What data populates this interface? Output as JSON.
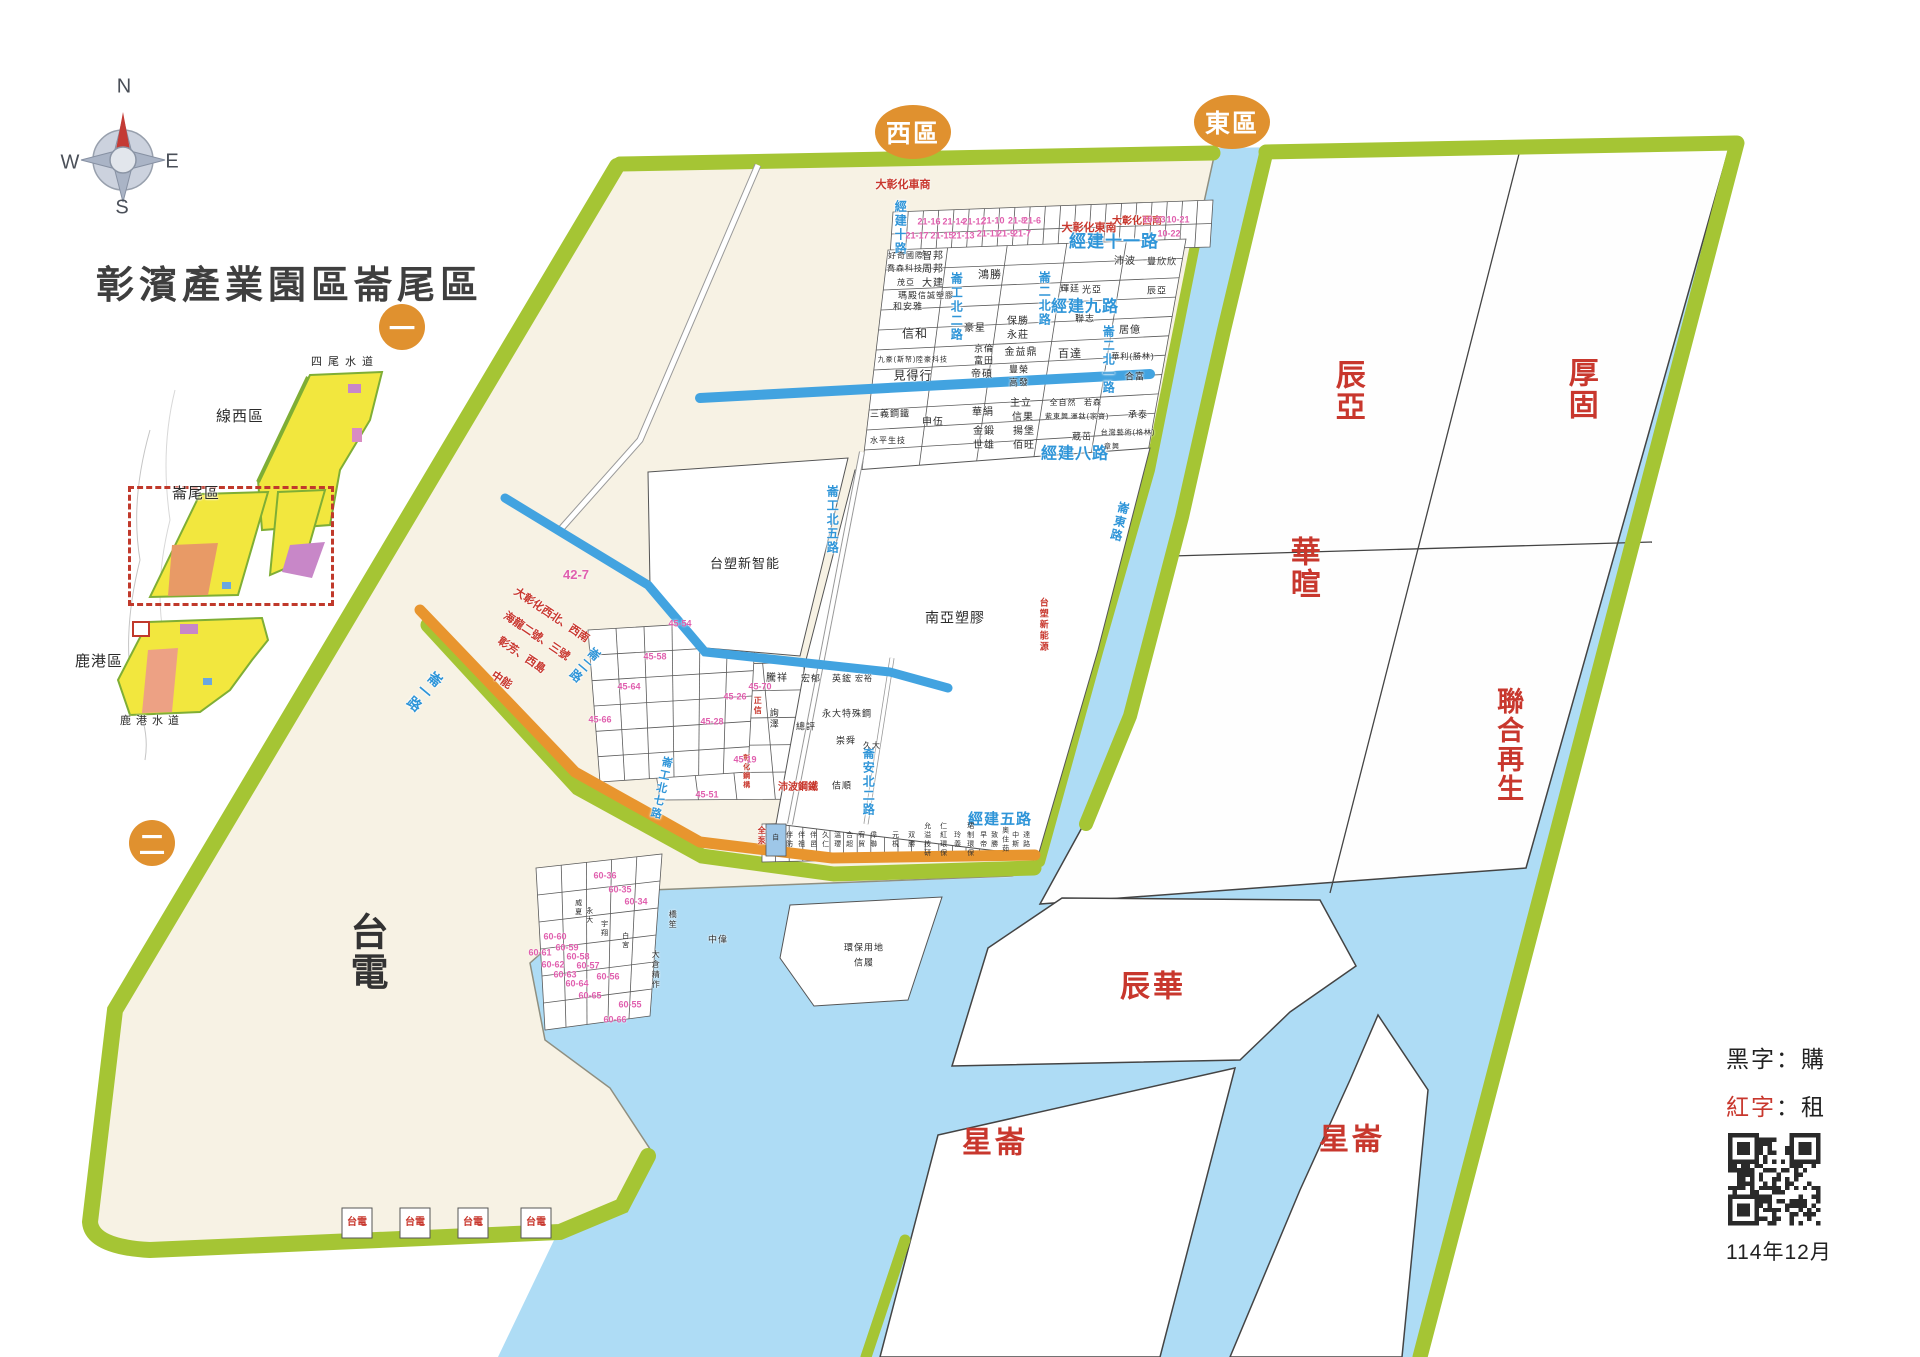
{
  "title": "彰濱產業園區崙尾區",
  "compass": {
    "north": "N",
    "east": "E",
    "south": "S",
    "west": "W"
  },
  "district_badges": {
    "west": "西區",
    "east": "東區",
    "marker_one": "一",
    "marker_two": "二"
  },
  "inset_map": {
    "waterway_top": "四尾水道",
    "zone_north": "線西區",
    "zone_focus": "崙尾區",
    "zone_south": "鹿港區",
    "waterway_bottom": "鹿港水道"
  },
  "legend": {
    "black_key": "黑字",
    "colon": "：",
    "black_value": "購",
    "red_key": "紅字",
    "red_value": "租",
    "date": "114年12月"
  },
  "colors": {
    "belt_green": "#a5c534",
    "water_blue": "#aedcf5",
    "land_cream": "#f7f2e4",
    "road_orange": "#e8952e",
    "channel_blue": "#42a3e0",
    "label_red": "#c8372d",
    "road_label_blue": "#2f95d8",
    "lot_pink": "#e05fae",
    "badge_orange": "#e0912f"
  },
  "map": {
    "zone_labels": [
      {
        "t": "辰亞",
        "x": 1347,
        "y": 391,
        "s": 30,
        "v": 1
      },
      {
        "t": "厚固",
        "x": 1580,
        "y": 389,
        "s": 30,
        "v": 1
      },
      {
        "t": "華暄",
        "x": 1302,
        "y": 568,
        "s": 30,
        "v": 1
      },
      {
        "t": "聯合再生",
        "x": 1508,
        "y": 745,
        "s": 27,
        "v": 1
      },
      {
        "t": "辰華",
        "x": 1153,
        "y": 987,
        "s": 30
      },
      {
        "t": "星崙",
        "x": 995,
        "y": 1143,
        "s": 30
      },
      {
        "t": "星崙",
        "x": 1352,
        "y": 1140,
        "s": 30
      },
      {
        "t": "台電",
        "x": 364,
        "y": 952,
        "s": 38,
        "v": 1,
        "c": "#333"
      }
    ],
    "road_labels": [
      {
        "t": "經建十一路",
        "x": 1114,
        "y": 242,
        "s": 17
      },
      {
        "t": "經建九路",
        "x": 1085,
        "y": 308,
        "s": 16
      },
      {
        "t": "經建八路",
        "x": 1075,
        "y": 455,
        "s": 16
      },
      {
        "t": "經建五路",
        "x": 1000,
        "y": 820,
        "s": 15
      },
      {
        "t": "經建十路",
        "x": 900,
        "y": 228,
        "s": 12,
        "v": 1
      },
      {
        "t": "崙工北二路",
        "x": 956,
        "y": 307,
        "s": 12,
        "v": 1
      },
      {
        "t": "崙二北路",
        "x": 1044,
        "y": 299,
        "s": 12,
        "v": 1
      },
      {
        "t": "崙二北一路",
        "x": 1108,
        "y": 360,
        "s": 12,
        "v": 1
      },
      {
        "t": "崙工北五路",
        "x": 832,
        "y": 520,
        "s": 12,
        "v": 1
      },
      {
        "t": "崙安北二路",
        "x": 868,
        "y": 782,
        "s": 12,
        "v": 1
      },
      {
        "t": "崙東路",
        "x": 1119,
        "y": 522,
        "s": 12,
        "v": 1,
        "r": 14
      },
      {
        "t": "崙工北七路",
        "x": 660,
        "y": 788,
        "s": 11,
        "v": 1,
        "r": 12
      },
      {
        "t": "崙一路",
        "x": 424,
        "y": 692,
        "s": 14,
        "v": 1,
        "r": 40
      },
      {
        "t": "崙二路",
        "x": 584,
        "y": 665,
        "s": 12,
        "v": 1,
        "r": 40
      }
    ],
    "company_labels": [
      {
        "t": "好奇國際",
        "x": 906,
        "y": 256,
        "s": 8
      },
      {
        "t": "智邦",
        "x": 933,
        "y": 257,
        "s": 10
      },
      {
        "t": "喬森科技",
        "x": 905,
        "y": 269,
        "s": 8
      },
      {
        "t": "周邦",
        "x": 933,
        "y": 270,
        "s": 10
      },
      {
        "t": "茂亞",
        "x": 906,
        "y": 283,
        "s": 8
      },
      {
        "t": "大建",
        "x": 933,
        "y": 284,
        "s": 10
      },
      {
        "t": "瑪殿",
        "x": 908,
        "y": 296,
        "s": 9
      },
      {
        "t": "信誠塑膠",
        "x": 936,
        "y": 296,
        "s": 8
      },
      {
        "t": "和安雅",
        "x": 908,
        "y": 307,
        "s": 9
      },
      {
        "t": "鴻勝",
        "x": 990,
        "y": 276,
        "s": 11
      },
      {
        "t": "沛波",
        "x": 1125,
        "y": 262,
        "s": 10
      },
      {
        "t": "豐欣欣",
        "x": 1162,
        "y": 262,
        "s": 9
      },
      {
        "t": "辰亞",
        "x": 1157,
        "y": 291,
        "s": 9
      },
      {
        "t": "輝廷",
        "x": 1070,
        "y": 289,
        "s": 9
      },
      {
        "t": "光亞",
        "x": 1092,
        "y": 290,
        "s": 9
      },
      {
        "t": "保勝",
        "x": 1018,
        "y": 322,
        "s": 10
      },
      {
        "t": "永莊",
        "x": 1018,
        "y": 336,
        "s": 10
      },
      {
        "t": "豪星",
        "x": 975,
        "y": 329,
        "s": 10
      },
      {
        "t": "信和",
        "x": 915,
        "y": 334,
        "s": 12
      },
      {
        "t": "京倫",
        "x": 984,
        "y": 349,
        "s": 9
      },
      {
        "t": "富田",
        "x": 984,
        "y": 361,
        "s": 9
      },
      {
        "t": "金益鼎",
        "x": 1021,
        "y": 353,
        "s": 10
      },
      {
        "t": "帝碩",
        "x": 982,
        "y": 375,
        "s": 10
      },
      {
        "t": "豐榮",
        "x": 1019,
        "y": 370,
        "s": 9
      },
      {
        "t": "高發",
        "x": 1019,
        "y": 383,
        "s": 9
      },
      {
        "t": "九豪(斯帑)",
        "x": 897,
        "y": 360,
        "s": 7
      },
      {
        "t": "陸豪科技",
        "x": 932,
        "y": 360,
        "s": 7
      },
      {
        "t": "見得行",
        "x": 913,
        "y": 376,
        "s": 12
      },
      {
        "t": "三義鋼鐵",
        "x": 890,
        "y": 414,
        "s": 9
      },
      {
        "t": "申伍",
        "x": 933,
        "y": 423,
        "s": 10
      },
      {
        "t": "水平生技",
        "x": 888,
        "y": 441,
        "s": 8
      },
      {
        "t": "華絹",
        "x": 983,
        "y": 413,
        "s": 10
      },
      {
        "t": "主立",
        "x": 1021,
        "y": 404,
        "s": 10
      },
      {
        "t": "信果",
        "x": 1023,
        "y": 418,
        "s": 10
      },
      {
        "t": "金鍛",
        "x": 984,
        "y": 432,
        "s": 10
      },
      {
        "t": "揚堡",
        "x": 1024,
        "y": 432,
        "s": 10
      },
      {
        "t": "世雄",
        "x": 984,
        "y": 446,
        "s": 10
      },
      {
        "t": "佰旺",
        "x": 1024,
        "y": 446,
        "s": 10
      },
      {
        "t": "全自然",
        "x": 1063,
        "y": 403,
        "s": 8
      },
      {
        "t": "若森",
        "x": 1093,
        "y": 403,
        "s": 8
      },
      {
        "t": "紫東興",
        "x": 1057,
        "y": 417,
        "s": 7
      },
      {
        "t": "運鈦(家寶)",
        "x": 1090,
        "y": 417,
        "s": 7
      },
      {
        "t": "承泰",
        "x": 1138,
        "y": 415,
        "s": 9
      },
      {
        "t": "蔵茁",
        "x": 1082,
        "y": 437,
        "s": 9
      },
      {
        "t": "台灣藝術(格林)",
        "x": 1128,
        "y": 433,
        "s": 7
      },
      {
        "t": "章興",
        "x": 1112,
        "y": 447,
        "s": 7
      },
      {
        "t": "聯志",
        "x": 1085,
        "y": 319,
        "s": 9
      },
      {
        "t": "百達",
        "x": 1070,
        "y": 355,
        "s": 11
      },
      {
        "t": "居億",
        "x": 1130,
        "y": 331,
        "s": 10
      },
      {
        "t": "華利(勝林)",
        "x": 1133,
        "y": 357,
        "s": 8
      },
      {
        "t": "合富",
        "x": 1135,
        "y": 377,
        "s": 9
      },
      {
        "t": "南亞塑膠",
        "x": 955,
        "y": 618,
        "s": 14
      },
      {
        "t": "台塑新智能",
        "x": 745,
        "y": 564,
        "s": 13
      },
      {
        "t": "騰祥",
        "x": 777,
        "y": 679,
        "s": 10
      },
      {
        "t": "宏郁",
        "x": 811,
        "y": 679,
        "s": 9
      },
      {
        "t": "英鋐",
        "x": 842,
        "y": 679,
        "s": 9
      },
      {
        "t": "宏裕",
        "x": 864,
        "y": 679,
        "s": 8
      },
      {
        "t": "永大特殊鋼",
        "x": 847,
        "y": 714,
        "s": 9
      },
      {
        "t": "總評",
        "x": 806,
        "y": 727,
        "s": 9
      },
      {
        "t": "崇舜",
        "x": 846,
        "y": 741,
        "s": 9
      },
      {
        "t": "久大",
        "x": 872,
        "y": 746,
        "s": 8
      },
      {
        "t": "詢澤",
        "x": 773,
        "y": 719,
        "s": 9,
        "v": 1
      },
      {
        "t": "佶順",
        "x": 842,
        "y": 786,
        "s": 9
      },
      {
        "t": "環保用地",
        "x": 864,
        "y": 948,
        "s": 9
      },
      {
        "t": "信履",
        "x": 864,
        "y": 963,
        "s": 9
      },
      {
        "t": "威夏",
        "x": 578,
        "y": 908,
        "s": 7,
        "v": 1
      },
      {
        "t": "永大",
        "x": 589,
        "y": 916,
        "s": 7,
        "v": 1
      },
      {
        "t": "宇翔",
        "x": 604,
        "y": 929,
        "s": 7,
        "v": 1
      },
      {
        "t": "白宮",
        "x": 625,
        "y": 941,
        "s": 7,
        "v": 1
      },
      {
        "t": "橋笙",
        "x": 672,
        "y": 920,
        "s": 8,
        "v": 1
      },
      {
        "t": "中偉",
        "x": 718,
        "y": 940,
        "s": 9
      },
      {
        "t": "大倉精作",
        "x": 655,
        "y": 970,
        "s": 8,
        "v": 1
      }
    ],
    "red_labels": [
      {
        "t": "大彰化車商",
        "x": 903,
        "y": 186,
        "s": 11
      },
      {
        "t": "大彰化東南",
        "x": 1089,
        "y": 229,
        "s": 11
      },
      {
        "t": "大彰化西南",
        "x": 1137,
        "y": 222,
        "s": 10
      },
      {
        "t": "大彰化西北、西南",
        "x": 551,
        "y": 616,
        "s": 11,
        "r": 34
      },
      {
        "t": "海龍二號、三號",
        "x": 536,
        "y": 637,
        "s": 11,
        "r": 34
      },
      {
        "t": "彰芳、西島",
        "x": 521,
        "y": 656,
        "s": 11,
        "r": 34
      },
      {
        "t": "中能",
        "x": 501,
        "y": 681,
        "s": 11,
        "r": 34
      },
      {
        "t": "沛波鋼鐵",
        "x": 798,
        "y": 788,
        "s": 10
      },
      {
        "t": "台塑新能源",
        "x": 1043,
        "y": 625,
        "s": 9,
        "v": 1
      },
      {
        "t": "正信",
        "x": 757,
        "y": 706,
        "s": 8,
        "v": 1
      },
      {
        "t": "彰化鋼構",
        "x": 746,
        "y": 772,
        "s": 7,
        "v": 1
      },
      {
        "t": "全泵",
        "x": 761,
        "y": 836,
        "s": 8,
        "v": 1
      }
    ],
    "lot_numbers": [
      {
        "t": "21-16",
        "x": 929,
        "y": 222
      },
      {
        "t": "21-14",
        "x": 954,
        "y": 222
      },
      {
        "t": "21-12",
        "x": 974,
        "y": 222
      },
      {
        "t": "21-17",
        "x": 917,
        "y": 236
      },
      {
        "t": "21-15",
        "x": 942,
        "y": 236
      },
      {
        "t": "21-13",
        "x": 963,
        "y": 236
      },
      {
        "t": "21-10",
        "x": 993,
        "y": 221
      },
      {
        "t": "21-8",
        "x": 1017,
        "y": 221
      },
      {
        "t": "21-6",
        "x": 1032,
        "y": 221
      },
      {
        "t": "21-11",
        "x": 988,
        "y": 234
      },
      {
        "t": "21-9",
        "x": 1006,
        "y": 234
      },
      {
        "t": "21-7",
        "x": 1022,
        "y": 234
      },
      {
        "t": "10-23",
        "x": 1154,
        "y": 220
      },
      {
        "t": "10-21",
        "x": 1178,
        "y": 220
      },
      {
        "t": "10-22",
        "x": 1169,
        "y": 234
      },
      {
        "t": "42-7",
        "x": 576,
        "y": 575,
        "s": 13
      },
      {
        "t": "45-54",
        "x": 680,
        "y": 624
      },
      {
        "t": "45-58",
        "x": 655,
        "y": 657
      },
      {
        "t": "45-64",
        "x": 629,
        "y": 687
      },
      {
        "t": "45-66",
        "x": 600,
        "y": 720
      },
      {
        "t": "45-70",
        "x": 760,
        "y": 687
      },
      {
        "t": "45-26",
        "x": 735,
        "y": 697
      },
      {
        "t": "45-28",
        "x": 712,
        "y": 722
      },
      {
        "t": "45-19",
        "x": 745,
        "y": 760
      },
      {
        "t": "45-51",
        "x": 707,
        "y": 795
      },
      {
        "t": "60-36",
        "x": 605,
        "y": 876
      },
      {
        "t": "60-35",
        "x": 620,
        "y": 890
      },
      {
        "t": "60-34",
        "x": 636,
        "y": 902
      },
      {
        "t": "60-60",
        "x": 555,
        "y": 937
      },
      {
        "t": "60-59",
        "x": 567,
        "y": 948
      },
      {
        "t": "60-61",
        "x": 540,
        "y": 953
      },
      {
        "t": "60-58",
        "x": 578,
        "y": 957
      },
      {
        "t": "60-62",
        "x": 553,
        "y": 965
      },
      {
        "t": "60-57",
        "x": 588,
        "y": 966
      },
      {
        "t": "60-63",
        "x": 565,
        "y": 975
      },
      {
        "t": "60-56",
        "x": 608,
        "y": 977
      },
      {
        "t": "60-64",
        "x": 577,
        "y": 984
      },
      {
        "t": "60-65",
        "x": 590,
        "y": 996
      },
      {
        "t": "60-55",
        "x": 630,
        "y": 1005
      },
      {
        "t": "60-66",
        "x": 615,
        "y": 1020
      }
    ],
    "strip_labels": [
      {
        "t": "自",
        "x": 775,
        "y": 838
      },
      {
        "t": "伴防",
        "x": 789,
        "y": 840
      },
      {
        "t": "伴祖",
        "x": 801,
        "y": 840
      },
      {
        "t": "伴邑",
        "x": 813,
        "y": 840
      },
      {
        "t": "久仁",
        "x": 825,
        "y": 840
      },
      {
        "t": "溫瓔",
        "x": 837,
        "y": 840
      },
      {
        "t": "合超",
        "x": 849,
        "y": 840
      },
      {
        "t": "宥貿",
        "x": 861,
        "y": 840
      },
      {
        "t": "偉聯",
        "x": 873,
        "y": 840
      },
      {
        "t": "元梘",
        "x": 895,
        "y": 840
      },
      {
        "t": "双勝",
        "x": 911,
        "y": 840
      },
      {
        "t": "允溢技研",
        "x": 927,
        "y": 840
      },
      {
        "t": "仁紅環保",
        "x": 943,
        "y": 840
      },
      {
        "t": "玲義",
        "x": 957,
        "y": 840
      },
      {
        "t": "珺制環保",
        "x": 970,
        "y": 840
      },
      {
        "t": "早帝",
        "x": 983,
        "y": 840
      },
      {
        "t": "致勝",
        "x": 994,
        "y": 840
      },
      {
        "t": "奧住茹",
        "x": 1005,
        "y": 840
      },
      {
        "t": "中斯",
        "x": 1015,
        "y": 840
      },
      {
        "t": "達路",
        "x": 1026,
        "y": 840
      }
    ],
    "taipower_boxes": [
      {
        "t": "台電",
        "x": 357,
        "y": 1223
      },
      {
        "t": "台電",
        "x": 415,
        "y": 1223
      },
      {
        "t": "台電",
        "x": 473,
        "y": 1223
      },
      {
        "t": "台電",
        "x": 536,
        "y": 1223
      }
    ]
  }
}
